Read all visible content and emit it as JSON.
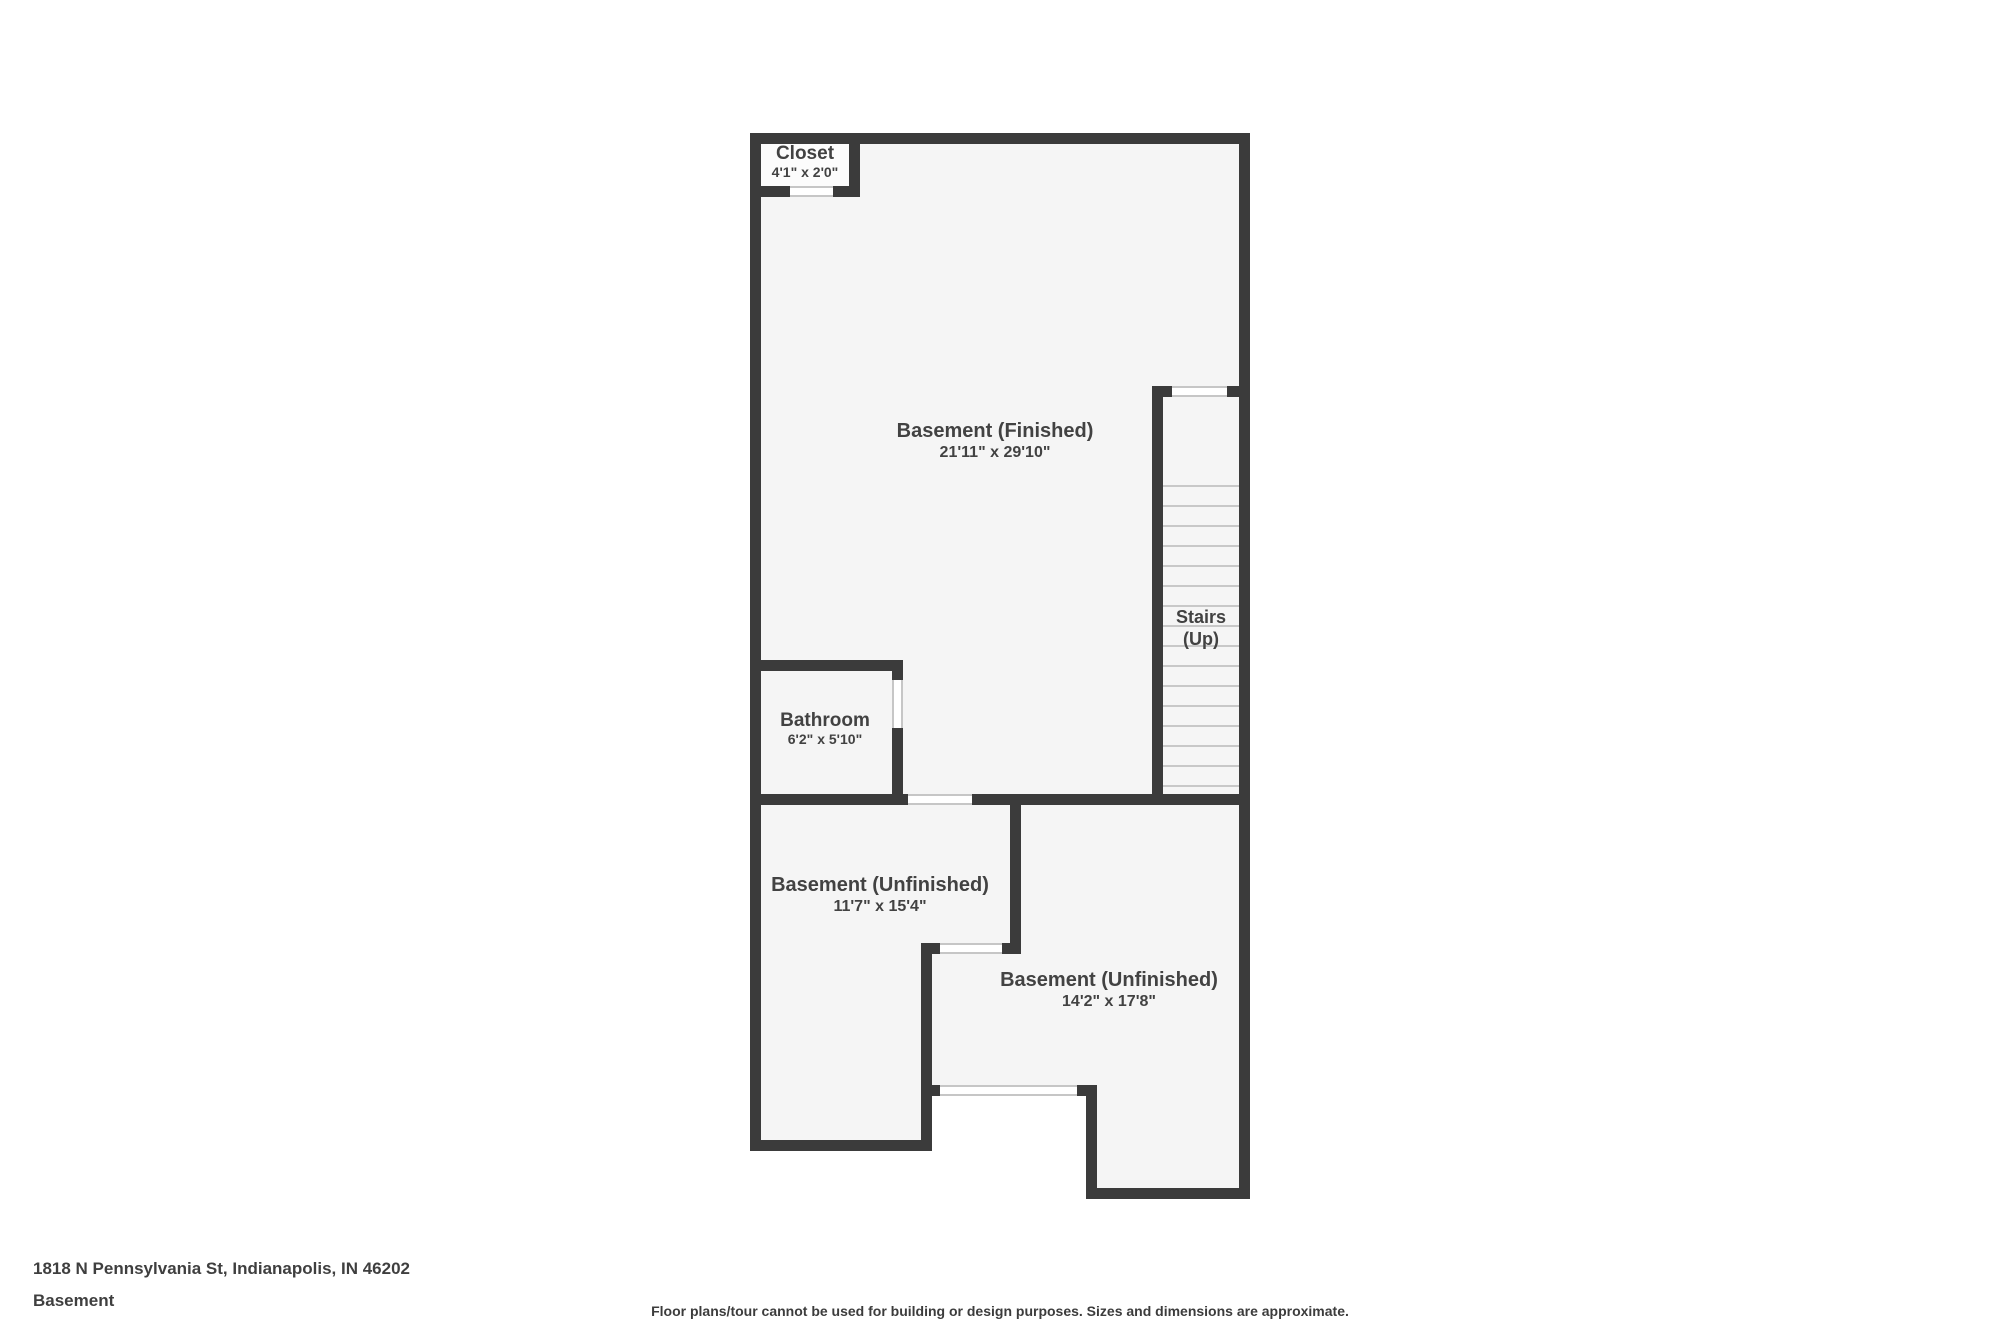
{
  "floorplan": {
    "wall_color": "#3b3b3b",
    "floor_color": "#f5f5f5",
    "closet_floor_color": "#fcfcfc",
    "tread_line_color": "#c8c8c8",
    "label_color": "#424242",
    "rooms": [
      {
        "id": "closet",
        "name": "Closet",
        "dims": "4'1\" x 2'0\""
      },
      {
        "id": "basement-finished",
        "name": "Basement (Finished)",
        "dims": "21'11\" x 29'10\""
      },
      {
        "id": "bathroom",
        "name": "Bathroom",
        "dims": "6'2\" x 5'10\""
      },
      {
        "id": "stairs",
        "line1": "Stairs",
        "line2": "(Up)"
      },
      {
        "id": "basement-unfinished-left",
        "name": "Basement (Unfinished)",
        "dims": "11'7\" x 15'4\""
      },
      {
        "id": "basement-unfinished-right",
        "name": "Basement (Unfinished)",
        "dims": "14'2\" x 17'8\""
      }
    ]
  },
  "footer": {
    "address": "1818 N Pennsylvania St, Indianapolis, IN 46202",
    "floor_label": "Basement",
    "disclaimer": "Floor plans/tour cannot be used for building or design purposes. Sizes and dimensions are approximate."
  }
}
